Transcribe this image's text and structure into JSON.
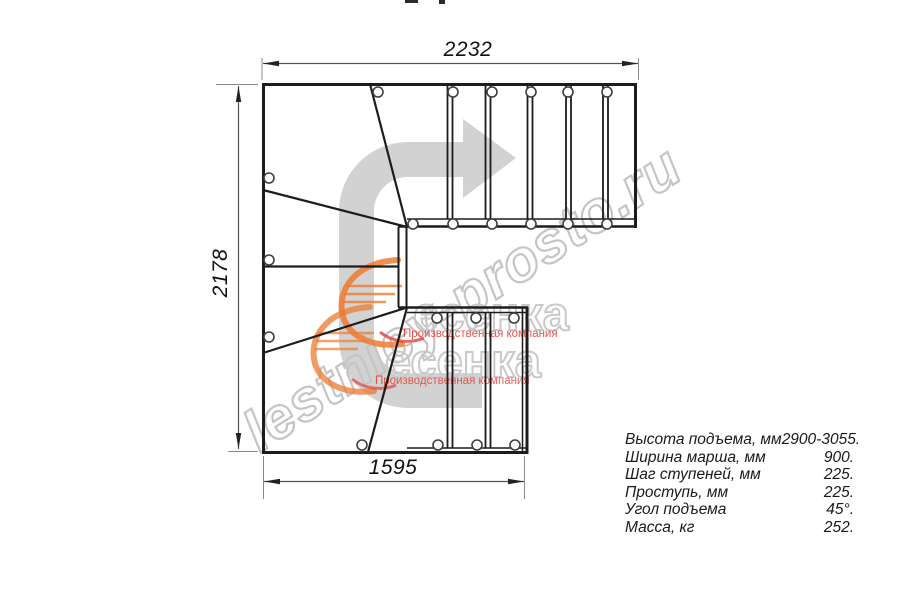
{
  "drawing": {
    "title_semantics": "staircase-floor-plan-u-turn-with-winders",
    "dimensions": {
      "top": "2232",
      "left": "2178",
      "bottom": "1595"
    },
    "direction_arrow_icon": "u-turn-direction-arrow",
    "colors": {
      "line": "#1c1c1c",
      "arrow_fill": "#d2d2d2",
      "watermark_outline": "#c5c5c5",
      "logo_orange": "#ee7b31",
      "logo_red": "#e4423a"
    }
  },
  "specs": {
    "rows": [
      {
        "label": "Высота подъема, мм",
        "value": "2900-3055."
      },
      {
        "label": "Ширина марша, мм",
        "value": "900."
      },
      {
        "label": "Шаг ступеней, мм",
        "value": "225."
      },
      {
        "label": "Проступь, мм",
        "value": "225."
      },
      {
        "label": "Угол подъема",
        "value": "45°."
      },
      {
        "label": "Масса, кг",
        "value": "252."
      }
    ]
  },
  "watermark": {
    "site": "lestnicy-prosto.ru",
    "logo_text": "есенка",
    "logo_tagline": "Производственная компания"
  }
}
